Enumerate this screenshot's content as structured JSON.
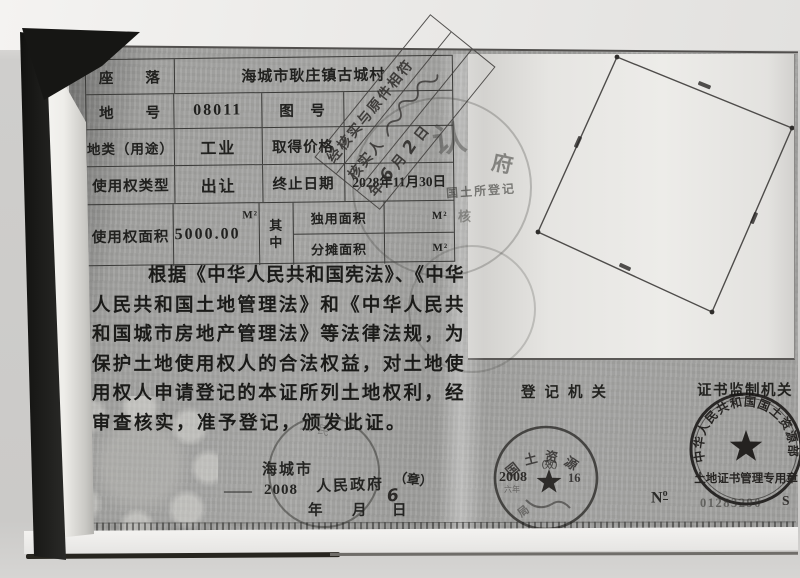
{
  "table": {
    "location_label": "座　　落",
    "location_value": "海城市耿庄镇古城村",
    "land_no_label": "地　　号",
    "land_no_value": "08011",
    "map_no_label": "图　号",
    "map_no_value": "",
    "land_class_label": "地类（用途）",
    "land_class_value": "工业",
    "price_label": "取得价格",
    "price_value": "",
    "tenure_label": "使用权类型",
    "tenure_value": "出让",
    "expiry_label": "终止日期",
    "expiry_value": "2028年11月30日",
    "area_label": "使用权面积",
    "area_value": "5000.00",
    "area_unit": "M²",
    "among_label": "其中",
    "exclusive_label": "独用面积",
    "exclusive_unit": "M²",
    "apportioned_label": "分摊面积",
    "apportioned_unit": "M²"
  },
  "verify_stamp": {
    "line1": "经核实与原件相符",
    "verifier_label": "核实人",
    "year_label": "年",
    "month_value": "6",
    "month_label": "月",
    "day_value": "2",
    "day_label": "日"
  },
  "legal_text": {
    "lines": [
      "根据《中华人民共和国宪法》、《中华",
      "人民共和国土地管理法》和《中华人民共",
      "和国城市房地产管理法》等法律法规，为",
      "保护土地使用权人的合法权益，对土地使",
      "用权人申请登记的本证所列土地权利，经",
      "审查核实，准予登记，颁发此证。"
    ]
  },
  "issue": {
    "city": "海城市",
    "dash": "——",
    "year": "2008",
    "gov": "人民政府",
    "seal_mark": "（章）",
    "month_hand": "6",
    "year_label": "年",
    "month_label": "月",
    "day_label": "日",
    "arc_hint": "人民"
  },
  "footer": {
    "registration_label": "登记机关",
    "supervision_label": "证书监制机关"
  },
  "registration_seal": {
    "arc_text": "国土资源",
    "year": "2008",
    "mark": "（效）",
    "day": "16",
    "sub_year": "六年",
    "bottom_char": "局"
  },
  "supervision_seal": {
    "arc_text": "中华人民共和国国土资源部",
    "bottom_text": "土地证书管理专用章",
    "no_prefix": "N",
    "no_sup": "o",
    "number": "01283290",
    "suffix": "S"
  },
  "ghost_marks": {
    "ren": "认",
    "fu": "府",
    "guotu": "国土所登记",
    "he": "核"
  }
}
